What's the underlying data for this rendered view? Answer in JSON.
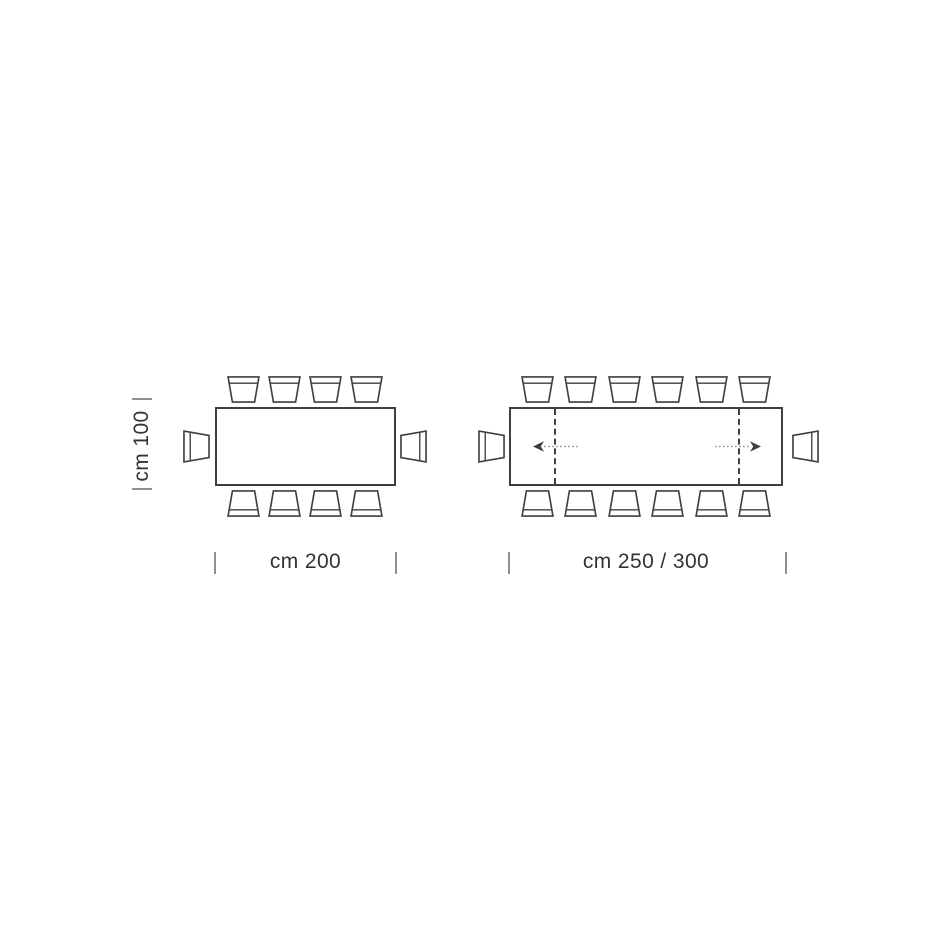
{
  "colors": {
    "background": "#ffffff",
    "line": "#3f3f3f",
    "text": "#333333",
    "tick": "#8f8f8f",
    "arrow_shaft": "#999999"
  },
  "diagrams": [
    {
      "name": "fixed rectangular table, top view",
      "width_label": "cm 200",
      "height_label": "cm 100",
      "seats_top": 4,
      "seats_bottom": 4,
      "seats_left_end": 1,
      "seats_right_end": 1,
      "extendable": false
    },
    {
      "name": "extendable rectangular table, top view",
      "width_label": "cm 250 / 300",
      "seats_top": 6,
      "seats_bottom": 6,
      "seats_left_end": 1,
      "seats_right_end": 1,
      "extendable": true
    }
  ]
}
